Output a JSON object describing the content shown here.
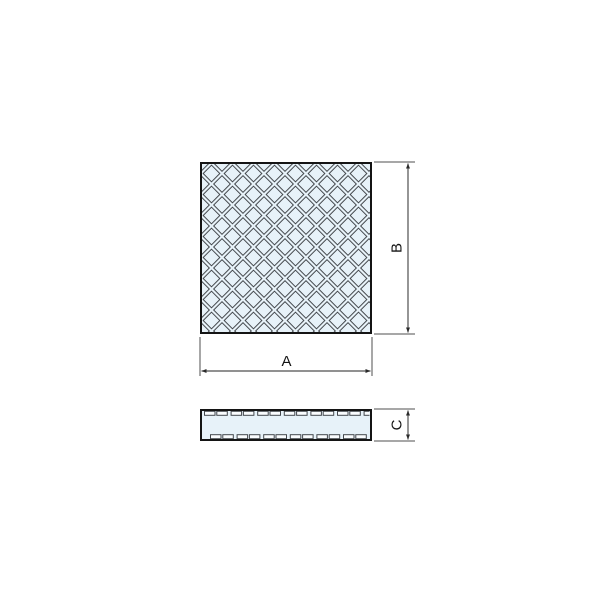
{
  "drawing": {
    "labels": {
      "width": "A",
      "height": "B",
      "thickness": "C"
    },
    "colors": {
      "background": "#ffffff",
      "pad_fill": "#e7f2f9",
      "pattern_line": "#44484d",
      "outline": "#141414",
      "dim_line": "#4f4f4f",
      "arrow": "#2a2a2a",
      "text": "#141414",
      "dash_fill": "#fafdff"
    }
  }
}
